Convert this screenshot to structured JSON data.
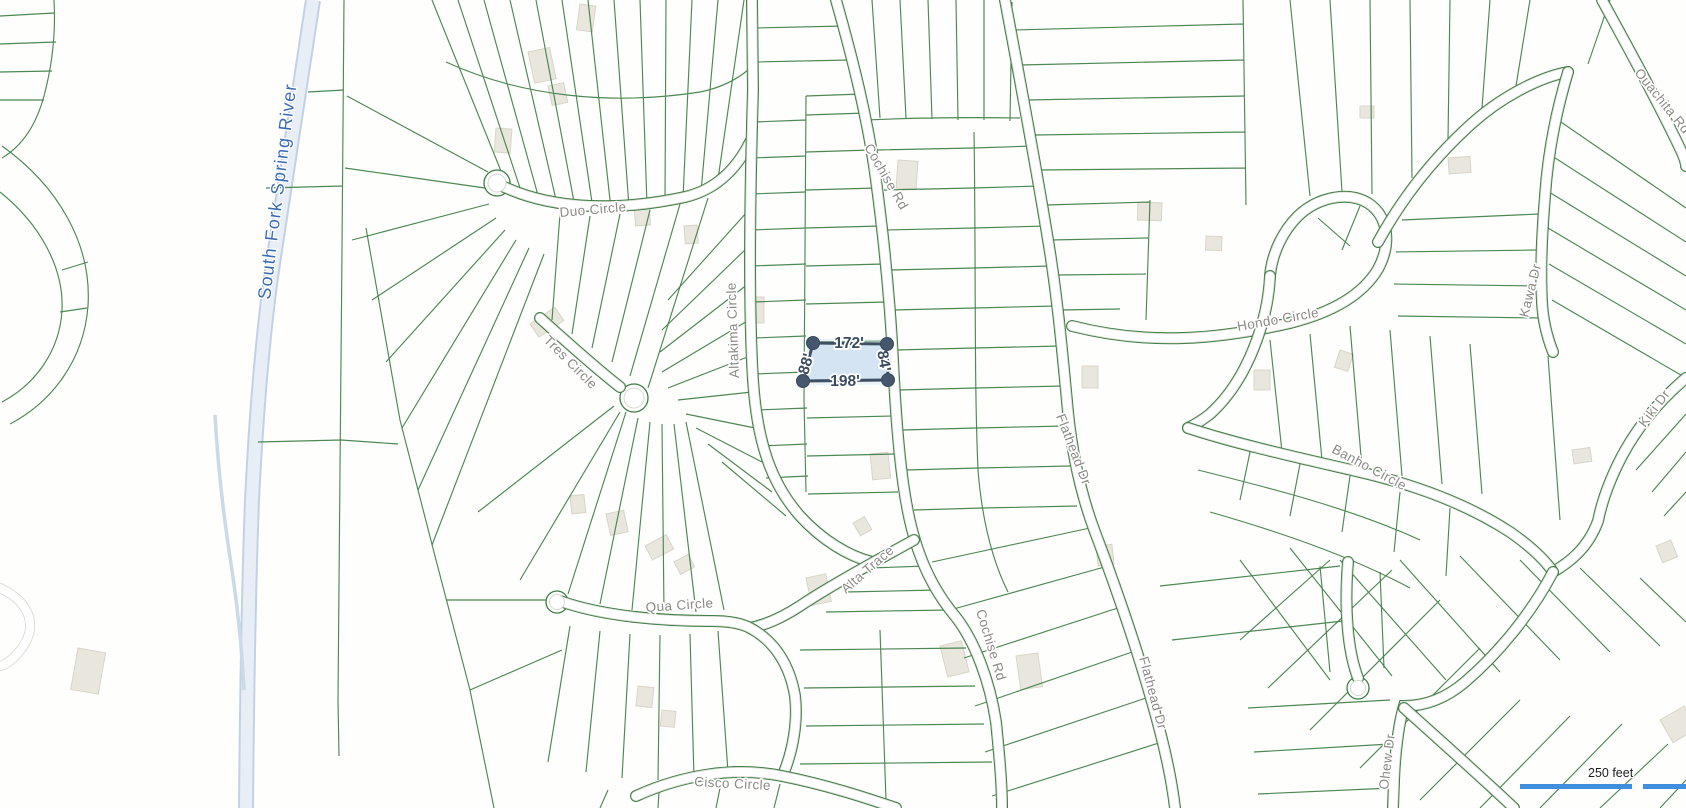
{
  "map": {
    "water": {
      "river_label": "South Fork Spring River"
    },
    "road_labels": [
      {
        "text": "Duo Circle"
      },
      {
        "text": "Cochise Rd"
      },
      {
        "text": "Altakima Circle"
      },
      {
        "text": "Tres Circle"
      },
      {
        "text": "Hondo Circle"
      },
      {
        "text": "Ouachita Rd"
      },
      {
        "text": "Kawa Dr"
      },
      {
        "text": "Kiki Dr"
      },
      {
        "text": "Banho Circle"
      },
      {
        "text": "Alta Trace"
      },
      {
        "text": "Qua Circle"
      },
      {
        "text": "Flathead Dr"
      },
      {
        "text": "Cochise Rd"
      },
      {
        "text": "Flathead Dr"
      },
      {
        "text": "Ohew Dr"
      },
      {
        "text": "Cisco Circle"
      }
    ],
    "measurement": {
      "top": "172'",
      "right": "84'",
      "bottom": "198'",
      "left": "88'"
    },
    "scale_bar": {
      "label": "250 feet"
    },
    "colors": {
      "parcel_line": "#3e7d45",
      "road_label": "#8c8a86",
      "river_label": "#3b6cb3",
      "water": "#c3d2e2",
      "selection_fill": "#cfe0f2",
      "selection_line": "#3e4e63",
      "scale_bar": "#3f8fde",
      "building": "#e9e6de"
    }
  }
}
